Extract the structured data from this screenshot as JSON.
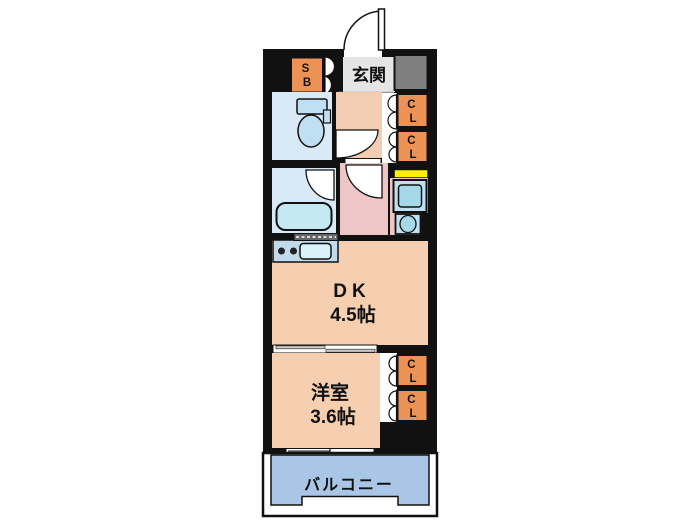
{
  "plan": {
    "entrance_label": "玄関",
    "dk_name": "DK",
    "dk_size": "4.5帖",
    "western_name": "洋室",
    "western_size": "3.6帖",
    "balcony_label": "バルコニー",
    "shoe_box": {
      "top": "S",
      "bottom": "B"
    },
    "closet": {
      "top": "C",
      "bottom": "L"
    }
  },
  "colors": {
    "wall": "#111111",
    "storage_orange": "#EC9254",
    "entrance_gray": "#E5E5E5",
    "meter_gray": "#7F7F7F",
    "floor_peach": "#F5CFAF",
    "hallway_peach": "#F3CDB2",
    "washroom_pink": "#EFC6C6",
    "wet_room_blue": "#D9E9F5",
    "fixture_blue": "#BFDFF2",
    "fixture_cyan": "#A5D9E9",
    "tub_cyan": "#C5E9F2",
    "counter_blue": "#C2DBEB",
    "sink_cyan": "#D9F3F8",
    "balcony_blue": "#A9C6E6",
    "highlight_yellow": "#FFF000"
  }
}
